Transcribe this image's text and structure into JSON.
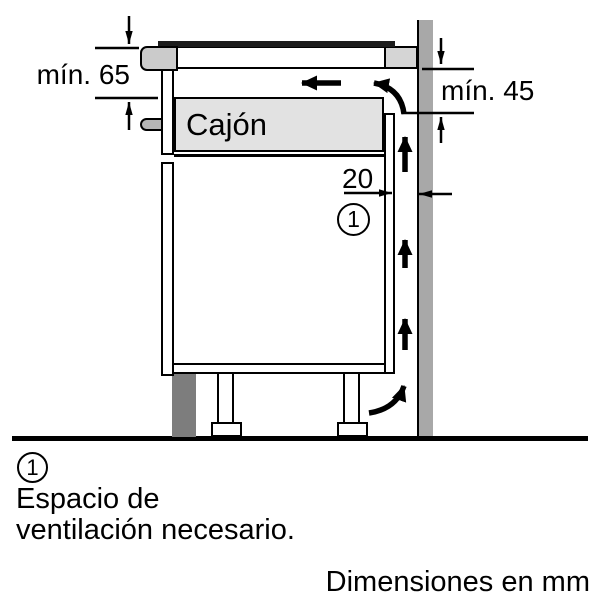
{
  "figure": {
    "type": "appliance-installation-side-section",
    "dimension_labels": {
      "hob_to_drawer": "mín. 65",
      "counter_to_back_panel": "mín. 45",
      "rear_gap": "20"
    },
    "drawer_label": "Cajón",
    "callout_number": "1",
    "colors": {
      "line": "#000000",
      "background": "#ffffff",
      "wall": "#a8a8a8",
      "plinth": "#7d7d7d",
      "drawer-fill": "#e2e2e2",
      "counter-block": "#d5d5d5",
      "hob-profile": "#cbcbcb",
      "handle": "#b5b5b5",
      "hob-glass": "#1c1c1c"
    }
  },
  "legend": {
    "callout_number": "1",
    "note_line1": "Espacio de",
    "note_line2": "ventilación necesario."
  },
  "footer": {
    "units_note": "Dimensiones en mm"
  }
}
